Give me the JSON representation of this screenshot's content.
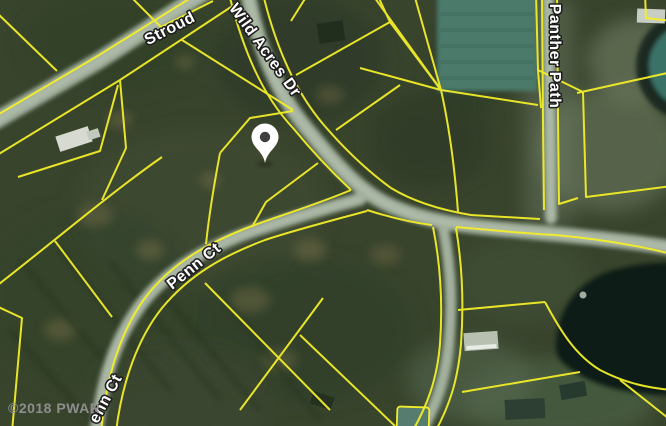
{
  "map": {
    "description": "satellite parcel map with lot boundaries",
    "labels": {
      "stroud": "Stroud",
      "wild_acres": "Wild Acres Dr",
      "panther": "Panther Path",
      "penn": "Penn Ct",
      "penn_partial": "enn Ct"
    },
    "watermark": "©2018 PWAR",
    "marker": {
      "x": 265,
      "y": 148
    },
    "colors": {
      "forest": "#39442d",
      "parcel_line": "#f2ee2a",
      "road": "#a2b09d",
      "road_center": "#c2ccbc",
      "pond_teal": "#3a7268",
      "pond_dark": "#0f1c13",
      "label_text": "#ffffff",
      "label_outline": "#1c1c1c",
      "watermark_gray": "#8e8e8e",
      "pin_fill": "#ffffff",
      "pin_hole": "#3f3f3f"
    }
  }
}
